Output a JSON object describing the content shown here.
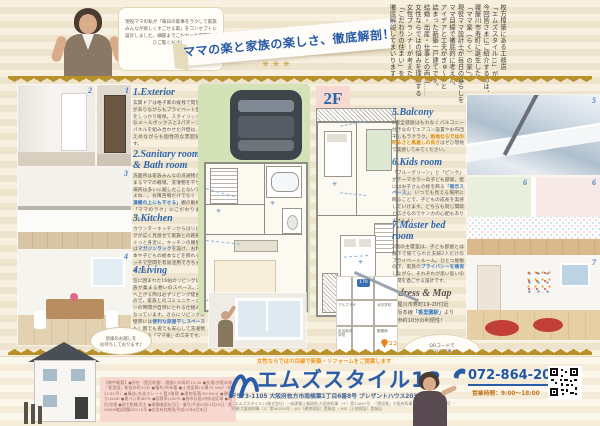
{
  "header": {
    "bubble": "現役ママの私が「毎日の家事をラクして家族みんなが楽しくすごせる家」をコンセプトに設計しました。細部までこだわった空間をぜひご覧ください！",
    "ribbon": "ママの楽と家族の楽しさ、徹底解剖！",
    "stars": "✳ ✳ ✳",
    "intro": "枚方樟葉にある工務店\n「エムズスタイル13」が\n今回皆さまにご紹介するのは、\n寝屋川市寿町に誕生した\n「ママ楽（らく）の家」。\n現役ママ設計士が毎日の暮らしを\nママ目線で徹底的に考えた、\nアイデアと工夫がぎゅ～っと\n詰まった新築一戸建てです。\n結婚・出産・仕事との両立……\n女性ならではの悩みを理解する\n女性プランナーが考えた\n「こだわりの住まい」を\n徹底解説してまいります！"
  },
  "floor_labels": {
    "f1": "1F",
    "f2": "2F"
  },
  "sections": [
    {
      "num": "1",
      "heading": "1.Exterior",
      "body1": "玄関ドアは格子風の縦桟で開放感がありながらもプライベート空間をしっかり確保。スタイリッシュなメールボックスと2パターンのパネルを組み合わせた外壁は、控えめながらも個性的な雰囲気です。",
      "hl": "",
      "body2": ""
    },
    {
      "num": "2",
      "heading": "2.Sanitary room & Bath room",
      "body1": "洗面所は家族みんなの洗濯物が集まるママの戦場。洗濯物を干せる場所は多いに越したことないですよね…。お風呂場だけでなく",
      "hl": "「洗濯機の上にも干せる」",
      "body2": "棚の動線で「ママのラク」にこだわりました。"
    },
    {
      "num": "3",
      "heading": "3.Kitchen",
      "body1": "カウンターキッチンからはリビングが広く見渡せて家族との距離もぐっと身近に。キッチンの腰壁には",
      "hl": "マガジンラック",
      "body2": "を設け、お料理本や子どもの絵本などを飾れるニッチで空間を有効活用できちゃいますよ♪"
    },
    {
      "num": "4",
      "heading": "4.Living",
      "body1": "窓に囲まれた16帖のリビングは家族が集まる憩いのスペース。2階へ上がる際は必ずリビング経由なので、家族とのコミュニケーションの時間が自然にとれる仕組みになっています。さらにリビングの壁際には",
      "hl": "便利な部屋干しスペース",
      "body2": "も！雨でも夜でも安心して洗濯物を干せる「ママ楽」の工夫です。"
    },
    {
      "num": "5",
      "heading": "5.Balcony",
      "body1": "2階全部屋はもれなくバルコニー付きなのでエアコン設置やお布団干しもラクラク。",
      "hl": "角地ならではの明るさと風通しの良さ",
      "body2": "はぜひ現地で実感してみてください。"
    },
    {
      "num": "6",
      "heading": "6.Kids room",
      "body1": "「ブルーグリーン」と「ピンク」がテーマカラーの子ども部屋。壁にはお子さんの絵を飾る",
      "hl": "「展示スペース」",
      "body2": "。いつでも見える場所に飾ることで、子どもの成長を実感していけます。どちらも同じ間取と広さなのでケンカの心配もありませんよ♪"
    },
    {
      "num": "7",
      "heading": "7.Master bed room",
      "body1": "2階の主寝室は、子ども部屋とは廊下で隔てられた夫婦2人だけのプライベートルーム。ひとつ屋根の下、家族の",
      "hl": "プライバシーを確保",
      "body2": "しながら、それぞれが思い思いの時間を過ごせる設計です。"
    }
  ],
  "address_section": {
    "heading": "Adress & Map",
    "body1": "寝屋川市寿町19-20付近\n京阪本線",
    "hl": "「香里園駅」",
    "body2": "より\n徒歩約10分の利便性！"
  },
  "map": {
    "route": "170",
    "label1": "アルプラザ",
    "label2": "北中学校",
    "label3": "友呂岐中学校",
    "label4": "郵便局",
    "marker": "ココ"
  },
  "bubbles": {
    "visit": "皆様のお越しを\nお待ちしております♪",
    "qr": "QRコードで\nWEBの記事も\nぜひご覧ください！\n電話もお気軽に♪"
  },
  "property_box": "【物件概要】●所在（登記地番）/寝屋川市寿町19-20 ●交通/京阪本線「香里園」駅徒歩約10分 ●権利/所有権 ●土地面積/公簿75.16㎡（約22.81坪）●構造/木造スレート葺2階建 ●建物面積/93.96㎡ ●間取り/4LDK ●建ぺい率/60％ ●容積率/190％ ●都市計画/市街化区域 ●地目/宅地 ●取引態様/売主 ●建築確認年月日・番号/平成30年3月29日・第ONEX確認建築SZ110号 ●広告有効期限/平成30年6月末日",
  "footer": {
    "tagline": "女性ならではの目線で新築・リフォームをご提案します",
    "company": "エムズスタイル13",
    "address": "〒573-1105 大阪府枚方市南楠葉1丁目6番8号 プレザントハウス203",
    "license": "［エムズスタイル13株式会社］一級建築士事務所/大阪府知事（イ）第24067号 ・「建設業」大阪府知事（般-23）第13630号 ・宅建/大阪府知事（1）第56504号 ・JIO（建物保証）登録店 ・JHS（土地保証）登録店",
    "phone": "072-864-2022",
    "hours": "営業時間：9:00～18:00"
  },
  "colors": {
    "accent_blue": "#2a5ca8",
    "gold": "#b8912a",
    "orange": "#f0941e",
    "pink_label": "#f8d9d2"
  }
}
